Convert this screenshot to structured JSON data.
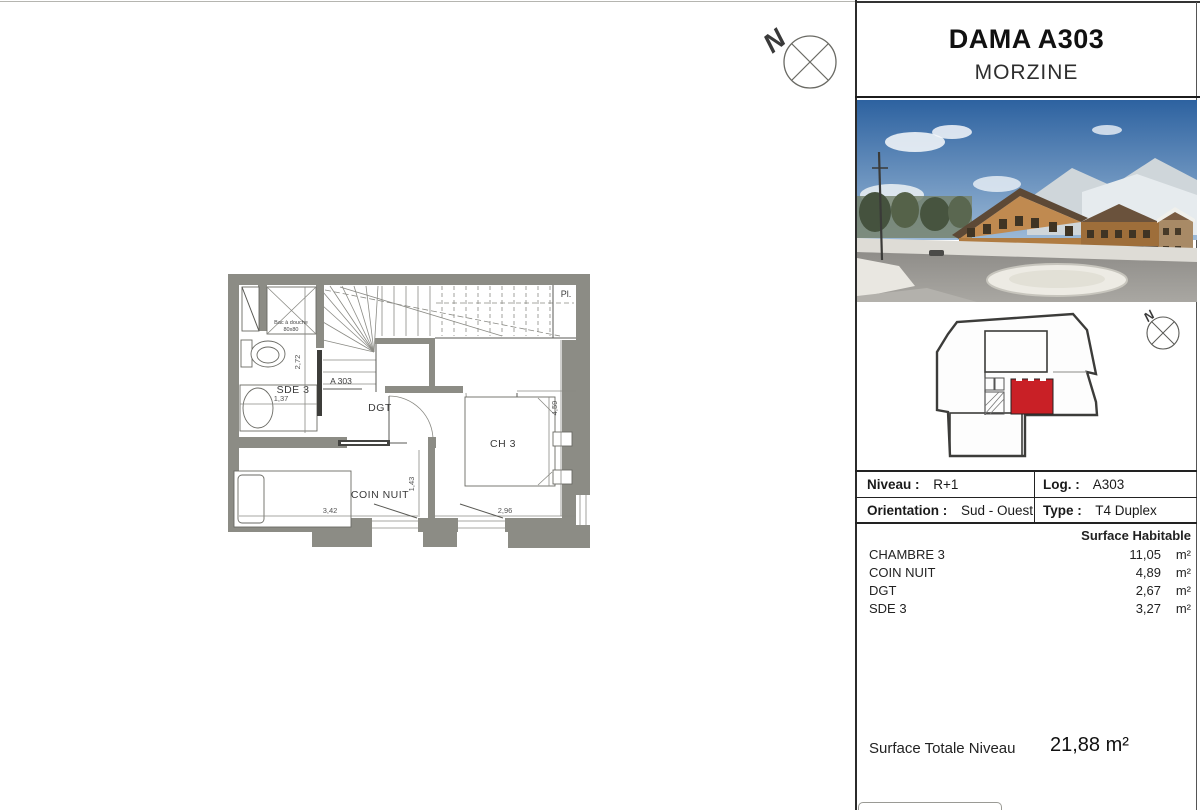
{
  "header": {
    "title": "DAMA A303",
    "subtitle": "MORZINE"
  },
  "compass": {
    "label": "N"
  },
  "floor_plan": {
    "labels": {
      "sde3": "SDE 3",
      "dgt": "DGT",
      "ch3": "CH 3",
      "coin_nuit": "COIN NUIT",
      "closet": "Pl.",
      "unit_door": "A 303",
      "shower_line1": "Bac à douche",
      "shower_line2": "80x80"
    },
    "dims": {
      "sde3_width": "1,37",
      "sde3_depth": "2,72",
      "coin_nuit_width": "3,42",
      "coin_nuit_depth": "1,43",
      "ch3_width": "2,96",
      "ch3_depth": "4,59"
    }
  },
  "site_plan": {
    "compass_label": "N",
    "highlight_color": "#c92026"
  },
  "info_table": {
    "niveau_label": "Niveau :",
    "niveau_value": "R+1",
    "log_label": "Log. :",
    "log_value": "A303",
    "orientation_label": "Orientation :",
    "orientation_value": "Sud - Ouest",
    "type_label": "Type :",
    "type_value": "T4 Duplex"
  },
  "surfaces": {
    "header": "Surface Habitable",
    "items": [
      {
        "name": "CHAMBRE 3",
        "value": "11,05",
        "unit": "m²"
      },
      {
        "name": "COIN NUIT",
        "value": "4,89",
        "unit": "m²"
      },
      {
        "name": "DGT",
        "value": "2,67",
        "unit": "m²"
      },
      {
        "name": "SDE 3",
        "value": "3,27",
        "unit": "m²"
      }
    ]
  },
  "total": {
    "label": "Surface Totale Niveau",
    "value": "21,88 m²"
  }
}
